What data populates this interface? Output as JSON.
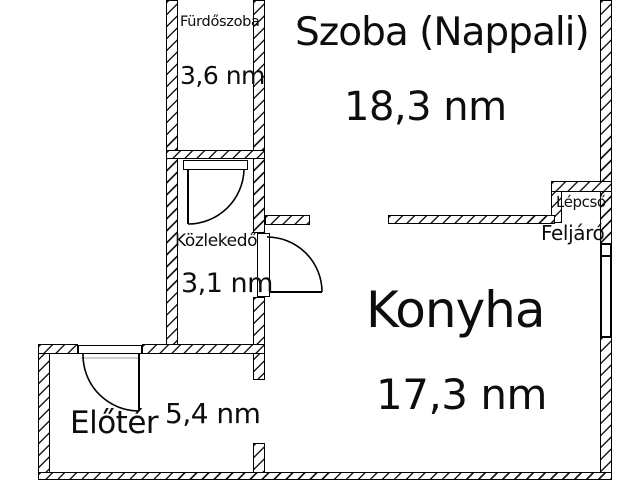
{
  "rooms": {
    "furdoszoba": {
      "name": "Fürdőszoba",
      "area": "3,6 nm"
    },
    "szoba": {
      "name": "Szoba (Nappali)",
      "area": "18,3 nm"
    },
    "kozlekedo": {
      "name": "Közlekedő",
      "area": "3,1 nm"
    },
    "konyha": {
      "name": "Konyha",
      "area": "17,3 nm"
    },
    "eloter": {
      "name": "Előtér",
      "area": "5,4 nm"
    },
    "lepcso": {
      "line1": "Lépcső",
      "line2": "Feljáró"
    }
  },
  "colors": {
    "wall_line": "#000000",
    "background": "#ffffff",
    "door_ghost_line": "#b5b5b5"
  }
}
